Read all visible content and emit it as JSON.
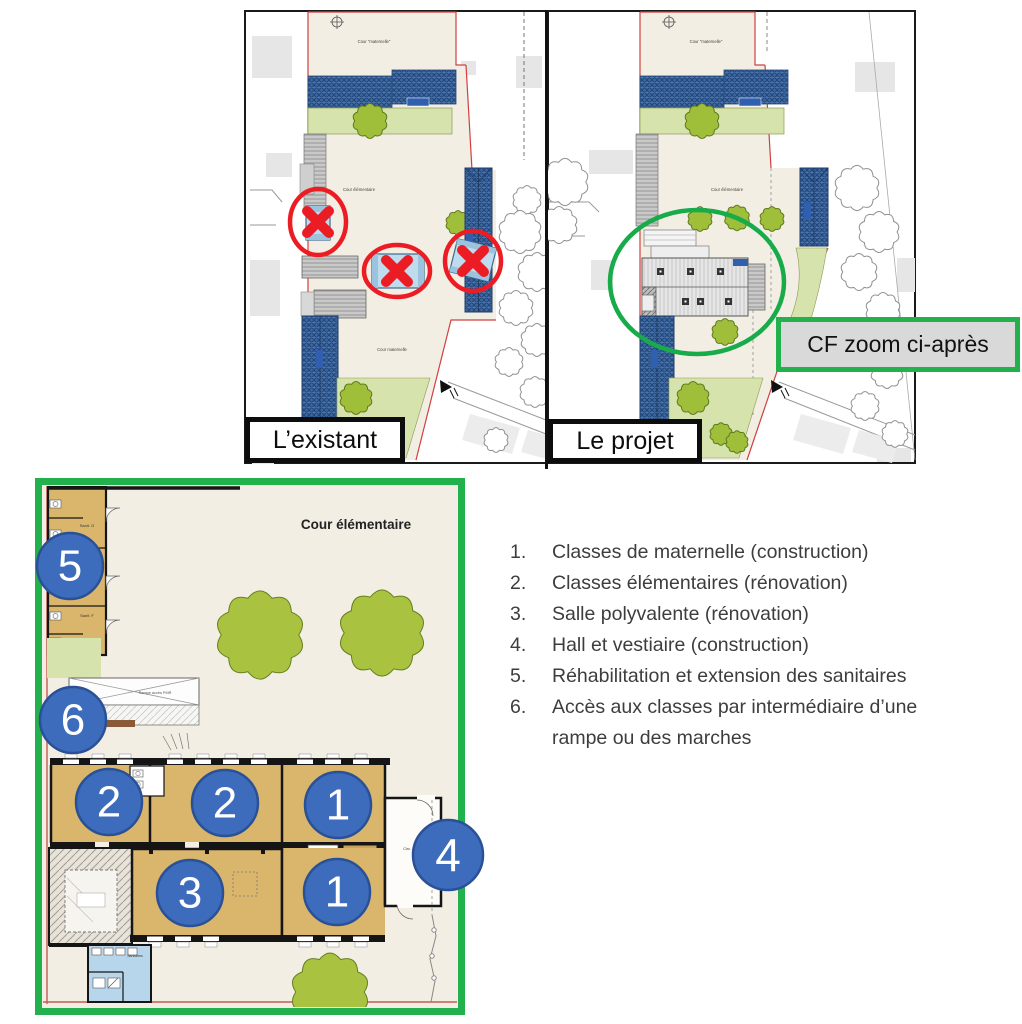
{
  "site_comparison": {
    "left_label": "L’existant",
    "right_label": "Le projet",
    "zoom_note": "CF zoom ci-après",
    "left_plan": {
      "courtyard_top": "Cour \"maternelle\"",
      "courtyard_middle": "Cour élémentaire",
      "courtyard_bottom": "Cour maternelle"
    },
    "right_plan": {
      "courtyard_top": "Cour \"maternelle\"",
      "courtyard_middle": "Cour élémentaire"
    }
  },
  "floor_plan": {
    "courtyard_label": "Cour élémentaire",
    "rooms": {
      "sanit_g": "Sanit. G",
      "sanit_f": "Sanit. F",
      "sanitaires": "Sanitaires",
      "hall": "Circ. / Vest.",
      "ramp": "Rampe accès PMR"
    },
    "markers": {
      "m1a": "1",
      "m1b": "1",
      "m2a": "2",
      "m2b": "2",
      "m3": "3",
      "m4": "4",
      "m5": "5",
      "m6": "6"
    }
  },
  "legend": {
    "items": [
      {
        "num": "1.",
        "text": "Classes de maternelle (construction)"
      },
      {
        "num": "2.",
        "text": "Classes élémentaires (rénovation)"
      },
      {
        "num": "3.",
        "text": "Salle polyvalente (rénovation)"
      },
      {
        "num": "4.",
        "text": "Hall et vestiaire (construction)"
      },
      {
        "num": "5.",
        "text": "Réhabilitation et extension des sanitaires"
      },
      {
        "num": "6.",
        "text": "Accès aux classes par intermédiaire d’une rampe ou des marches"
      }
    ]
  },
  "colors": {
    "accent_green": "#22b14c",
    "alert_red": "#ec1c24",
    "marker_blue": "#3d6cbd",
    "note_bg": "#d9d9d9",
    "site_cream": "#f3eee3",
    "roof_blue": "#3b67a1",
    "room_tan": "#d9b66c",
    "tree_green": "#a9c23f",
    "lawn_green": "#d7e3ad"
  }
}
